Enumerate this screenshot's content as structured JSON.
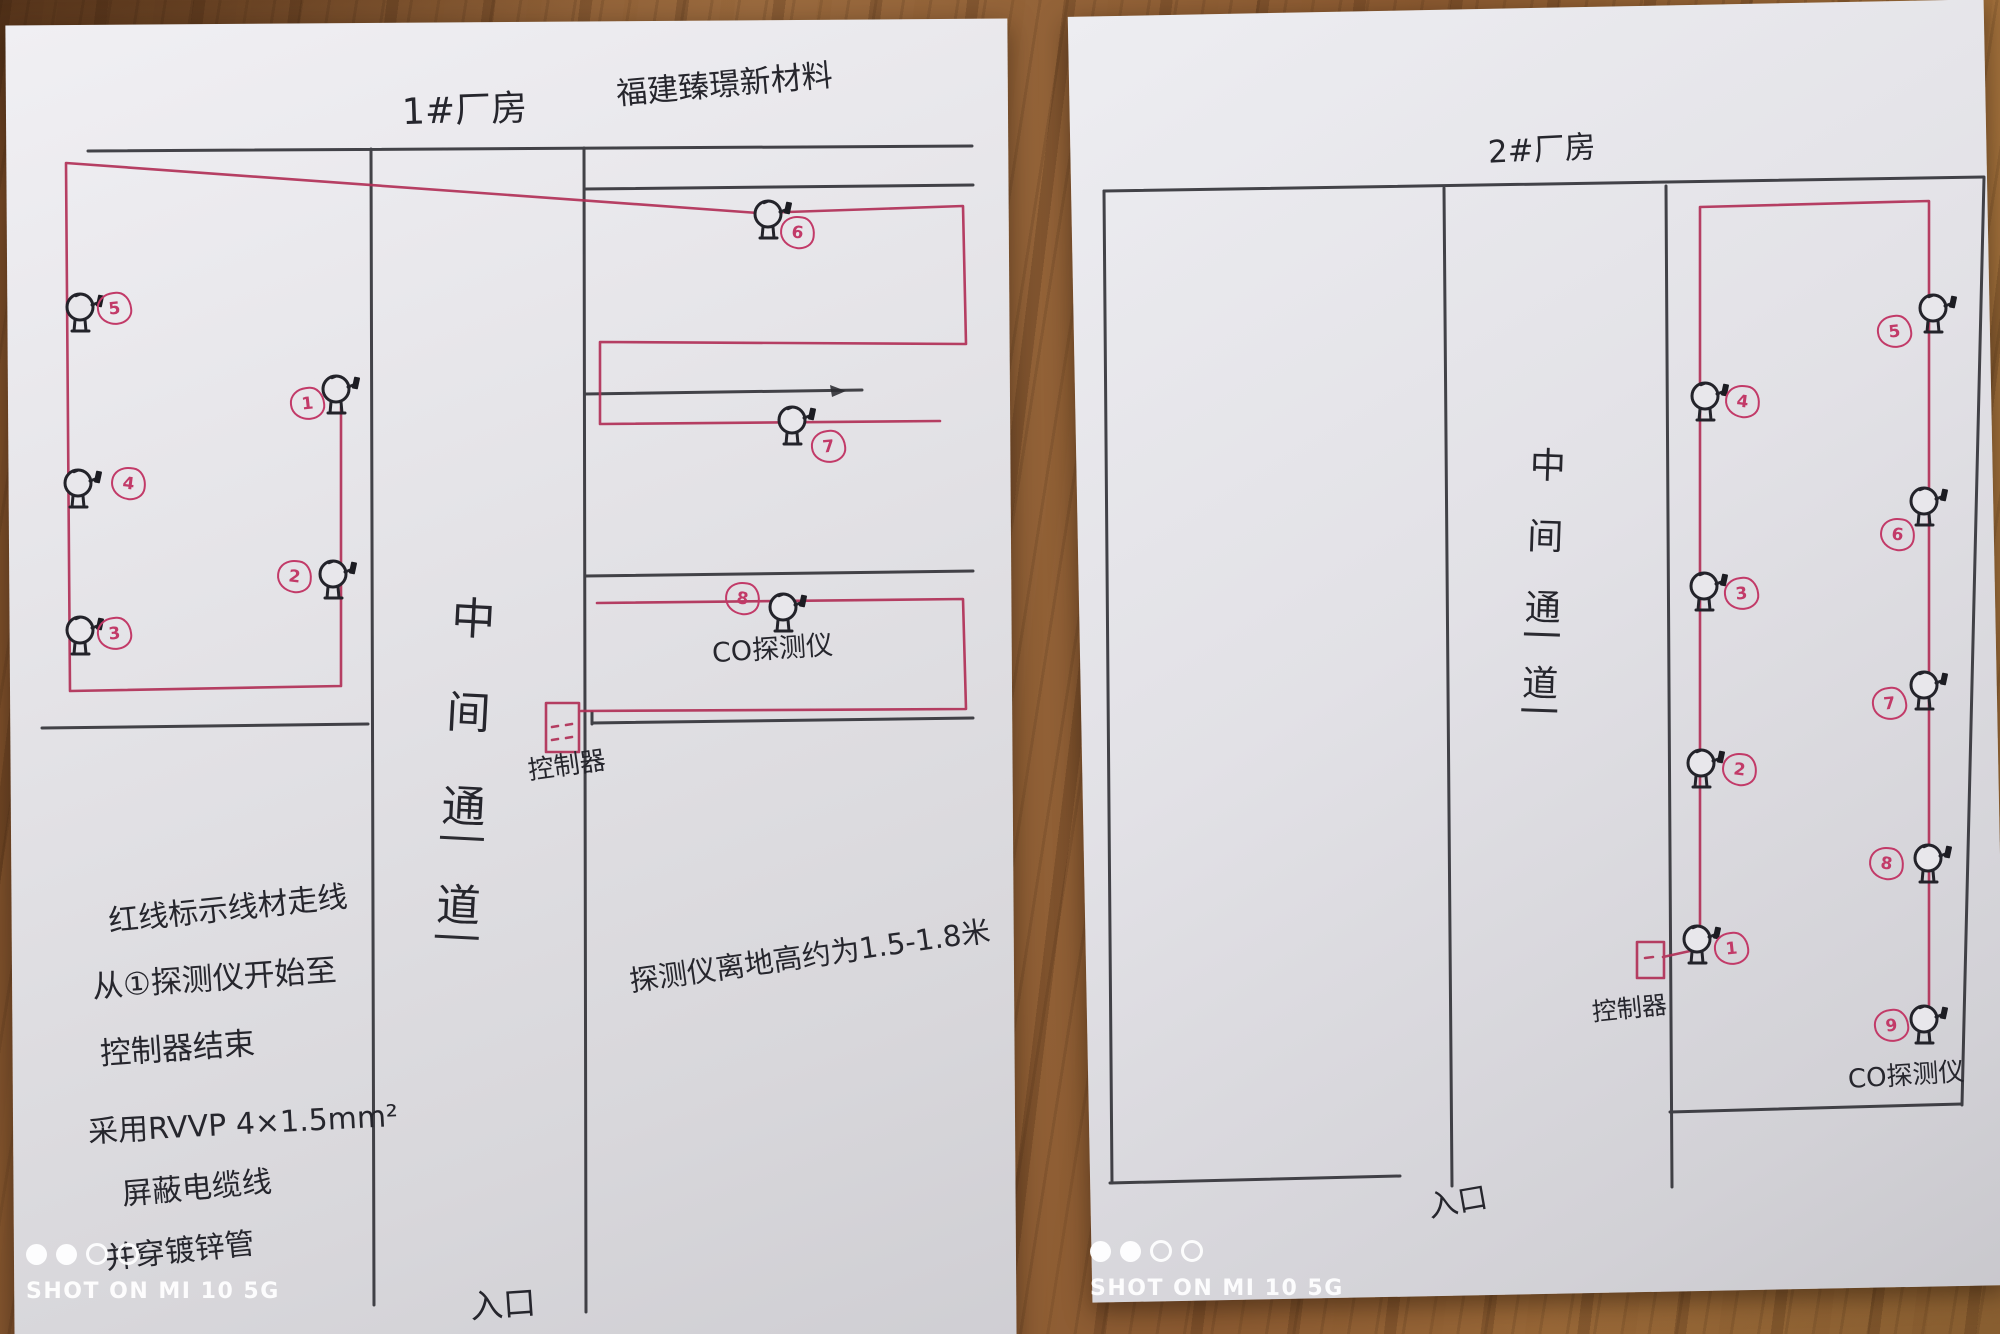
{
  "watermark": {
    "text": "SHOT ON MI 10 5G"
  },
  "colors": {
    "ink": "#2b2b31",
    "wire": "#b13057",
    "number_circle": "#c23a68"
  },
  "pages": [
    {
      "id": "page1",
      "title": "1#厂房",
      "company": "福建臻璟新材料",
      "corridor_label": "中间通道",
      "entrance_label": "入口",
      "co_detector_label": "CO探测仪",
      "controller_label": "控制器",
      "notes": [
        "红线标示线材走线",
        "从①探测仪开始至",
        "控制器结束"
      ],
      "cable_notes": [
        "采用RVVP 4×1.5mm²",
        "屏蔽电缆线",
        "并穿镀锌管"
      ],
      "height_note": "探测仪离地高约为1.5-1.8米",
      "detectors": [
        {
          "n": "1",
          "x": 336,
          "y": 389,
          "nx": 305,
          "ny": 401
        },
        {
          "n": "2",
          "x": 333,
          "y": 574,
          "nx": 292,
          "ny": 574
        },
        {
          "n": "3",
          "x": 80,
          "y": 630,
          "nx": 112,
          "ny": 631
        },
        {
          "n": "4",
          "x": 78,
          "y": 483,
          "nx": 126,
          "ny": 481
        },
        {
          "n": "5",
          "x": 80,
          "y": 307,
          "nx": 112,
          "ny": 306
        },
        {
          "n": "6",
          "x": 768,
          "y": 214,
          "nx": 795,
          "ny": 230
        },
        {
          "n": "7",
          "x": 792,
          "y": 420,
          "nx": 826,
          "ny": 444
        },
        {
          "n": "8",
          "x": 783,
          "y": 607,
          "nx": 740,
          "ny": 596
        }
      ]
    },
    {
      "id": "page2",
      "title": "2#厂房",
      "corridor_label": "中间通道",
      "entrance_label": "入口",
      "co_detector_label": "CO探测仪",
      "controller_label": "控制器",
      "detectors": [
        {
          "n": "1",
          "x": 1697,
          "y": 939,
          "nx": 1729,
          "ny": 946
        },
        {
          "n": "2",
          "x": 1701,
          "y": 763,
          "nx": 1737,
          "ny": 767
        },
        {
          "n": "3",
          "x": 1704,
          "y": 586,
          "nx": 1739,
          "ny": 591
        },
        {
          "n": "4",
          "x": 1705,
          "y": 396,
          "nx": 1740,
          "ny": 399
        },
        {
          "n": "5",
          "x": 1933,
          "y": 308,
          "nx": 1892,
          "ny": 329
        },
        {
          "n": "6",
          "x": 1924,
          "y": 501,
          "nx": 1895,
          "ny": 532
        },
        {
          "n": "7",
          "x": 1924,
          "y": 685,
          "nx": 1887,
          "ny": 701
        },
        {
          "n": "8",
          "x": 1928,
          "y": 858,
          "nx": 1884,
          "ny": 861
        },
        {
          "n": "9",
          "x": 1924,
          "y": 1019,
          "nx": 1889,
          "ny": 1023
        }
      ]
    }
  ]
}
